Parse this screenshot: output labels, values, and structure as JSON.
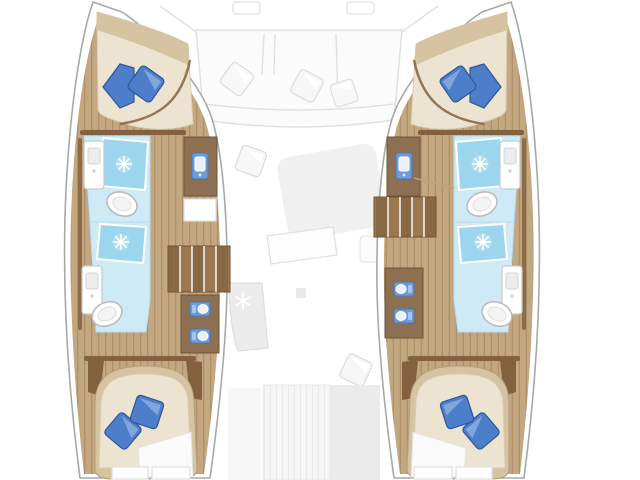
{
  "colors": {
    "hullStroke": "#a8a8a8",
    "wood": "#c3a780",
    "woodLine": "#ad8f68",
    "trim": "#83613f",
    "cabinetBrown": "#8d7051",
    "stair": "#9a7850",
    "stairDark": "#7c5c39",
    "bathFloor": "#cdeaf6",
    "shower": "#9bd6ee",
    "bedLinen": "#ece4d1",
    "headboard": "#d5c3a2",
    "bedRim": "#8a684a",
    "pillow": "#4d7ec9",
    "pillowLight": "#87abdf",
    "pillowStroke": "#2f5699",
    "sinkBlue": "#6d9bdc",
    "sinkBlueDark": "#4a77b8",
    "faintFill": "#f0f0f0",
    "faintStroke": "#e0e0e0"
  },
  "floorplan": {
    "type": "catamaran-yacht-deck-plan",
    "orientation": "bow-up",
    "saloon": {
      "foredeck_hatch_count": 2,
      "bow_sofa": {
        "seat_sections": 3,
        "pillow_count": 3
      },
      "lounge_scatter_pillow_count": 2,
      "dining_table_count": 1,
      "galley_block_with_snowflake_count": 1,
      "aft_cockpit": {
        "pillow_count": 1,
        "striped_door_panels": 1
      }
    },
    "hulls": [
      {
        "id": "port",
        "forward_cabin": {
          "double_berth": 1,
          "pillow_count": 2
        },
        "forward_head": {
          "shower": 1,
          "toilet": 1,
          "washbasin": 1,
          "vanity_sink": 1
        },
        "wardrobe_shelf_count": 1,
        "companionway_stair_treads": 5,
        "aft_vanity_sink_count": 2,
        "aft_head": {
          "shower": 1,
          "toilet": 1,
          "washbasin": 1
        },
        "aft_cabin": {
          "double_berth": 1,
          "pillow_count": 2,
          "drawer_fronts": 2
        }
      },
      {
        "id": "starboard",
        "forward_cabin": {
          "double_berth": 1,
          "pillow_count": 2
        },
        "forward_head": {
          "shower": 1,
          "toilet": 1,
          "washbasin": 1,
          "vanity_sink": 1
        },
        "wardrobe_shelf_count": 0,
        "companionway_stair_treads": 5,
        "aft_vanity_sink_count": 2,
        "aft_head": {
          "shower": 1,
          "toilet": 1,
          "washbasin": 1
        },
        "aft_cabin": {
          "double_berth": 1,
          "pillow_count": 2,
          "drawer_fronts": 2
        }
      }
    ],
    "totals": {
      "cabins": 4,
      "heads": 4,
      "showers": 4,
      "toilets": 4,
      "berths": 4
    }
  },
  "icons": {
    "shower_icon": "spray-starburst",
    "galley_icon": "snowflake",
    "vanity_icon": "sink-basin",
    "toilet_icon": "toilet-oval"
  }
}
